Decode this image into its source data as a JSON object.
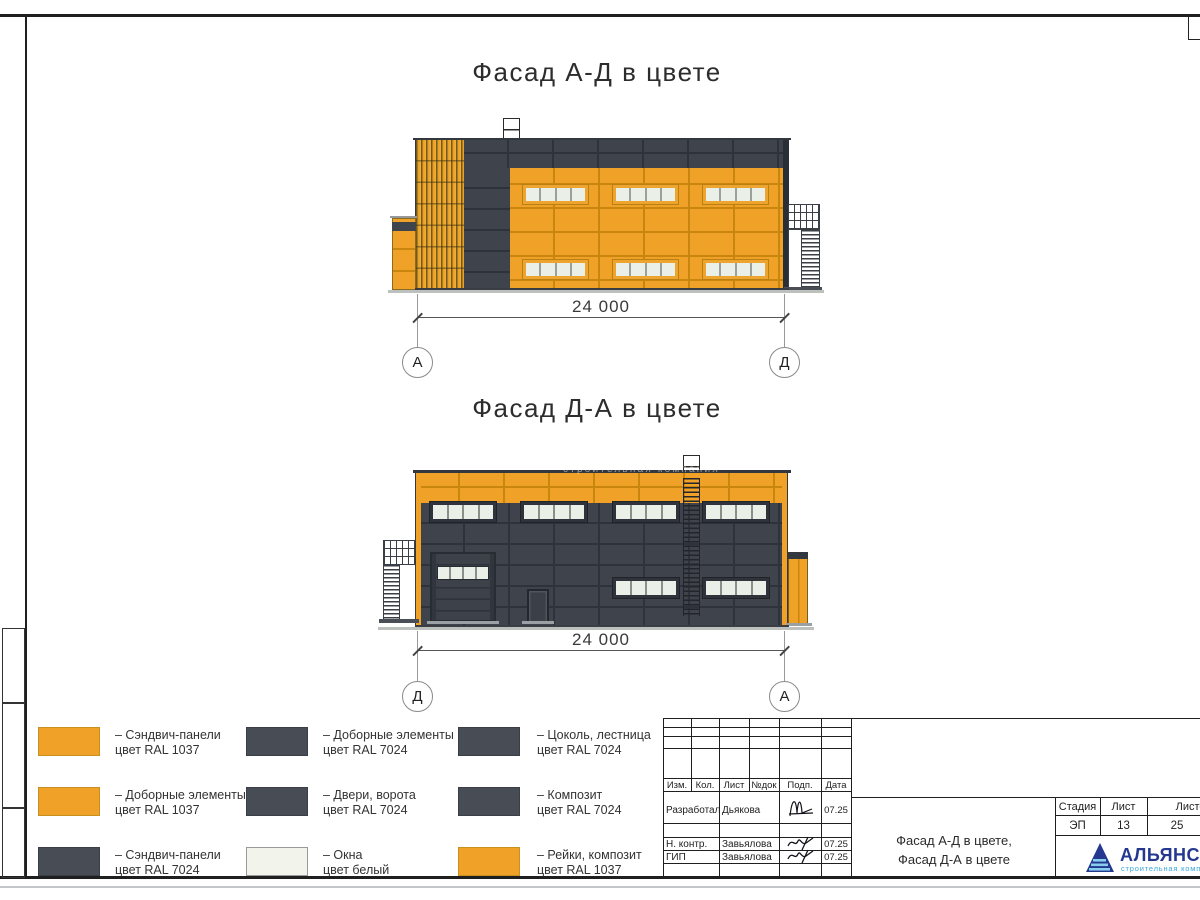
{
  "sheet": {
    "facade1": {
      "title": "Фасад А-Д в цвете",
      "dimension": "24 000",
      "axis_left": "А",
      "axis_right": "Д"
    },
    "facade2": {
      "title": "Фасад Д-А в цвете",
      "dimension": "24 000",
      "axis_left": "Д",
      "axis_right": "А"
    },
    "watermark": "строительная компания"
  },
  "legend": {
    "items": [
      {
        "line1": "– Сэндвич-панели",
        "line2": "цвет RAL 1037",
        "color": "#F0A228"
      },
      {
        "line1": "– Доборные элементы",
        "line2": "цвет RAL 1037",
        "color": "#F0A228"
      },
      {
        "line1": "– Сэндвич-панели",
        "line2": "цвет RAL 7024",
        "color": "#474C55"
      },
      {
        "line1": "– Доборные элементы",
        "line2": "цвет RAL 7024",
        "color": "#474C55"
      },
      {
        "line1": "– Двери, ворота",
        "line2": "цвет RAL 7024",
        "color": "#474C55"
      },
      {
        "line1": "– Окна",
        "line2": "цвет белый",
        "color": "#F2F4EC"
      },
      {
        "line1": "– Цоколь, лестница",
        "line2": "цвет RAL 7024",
        "color": "#474C55"
      },
      {
        "line1": "– Композит",
        "line2": "цвет RAL 7024",
        "color": "#474C55"
      },
      {
        "line1": "– Рейки, композит",
        "line2": "цвет RAL 1037",
        "color": "#F0A228"
      }
    ]
  },
  "titleblock": {
    "columns": {
      "izm": "Изм.",
      "kol": "Кол.",
      "list": "Лист",
      "ndok": "№док",
      "podp": "Подп.",
      "data": "Дата"
    },
    "rows": [
      {
        "role": "Разработал",
        "name": "Дьякова",
        "date": "07.25"
      },
      {
        "role": "Н. контр.",
        "name": "Завьялова",
        "date": "07.25"
      },
      {
        "role": "ГИП",
        "name": "Завьялова",
        "date": "07.25"
      }
    ],
    "stage": {
      "h1": "Стадия",
      "h2": "Лист",
      "h3": "Листов",
      "v1": "ЭП",
      "v2": "13",
      "v3": "25"
    },
    "doc_title": {
      "line1": "Фасад А-Д в цвете,",
      "line2": "Фасад Д-А в цвете"
    },
    "logo": {
      "name": "АЛЬЯНС",
      "subtitle": "строительная компания"
    }
  },
  "colors": {
    "ral1037_orange": "#F0A228",
    "ral7024_dark": "#3E434C",
    "window_pane": "#EAEFE7",
    "window_white": "#F2F4EC",
    "logo_blue": "#24388F",
    "logo_cyan": "#35A8DC"
  }
}
